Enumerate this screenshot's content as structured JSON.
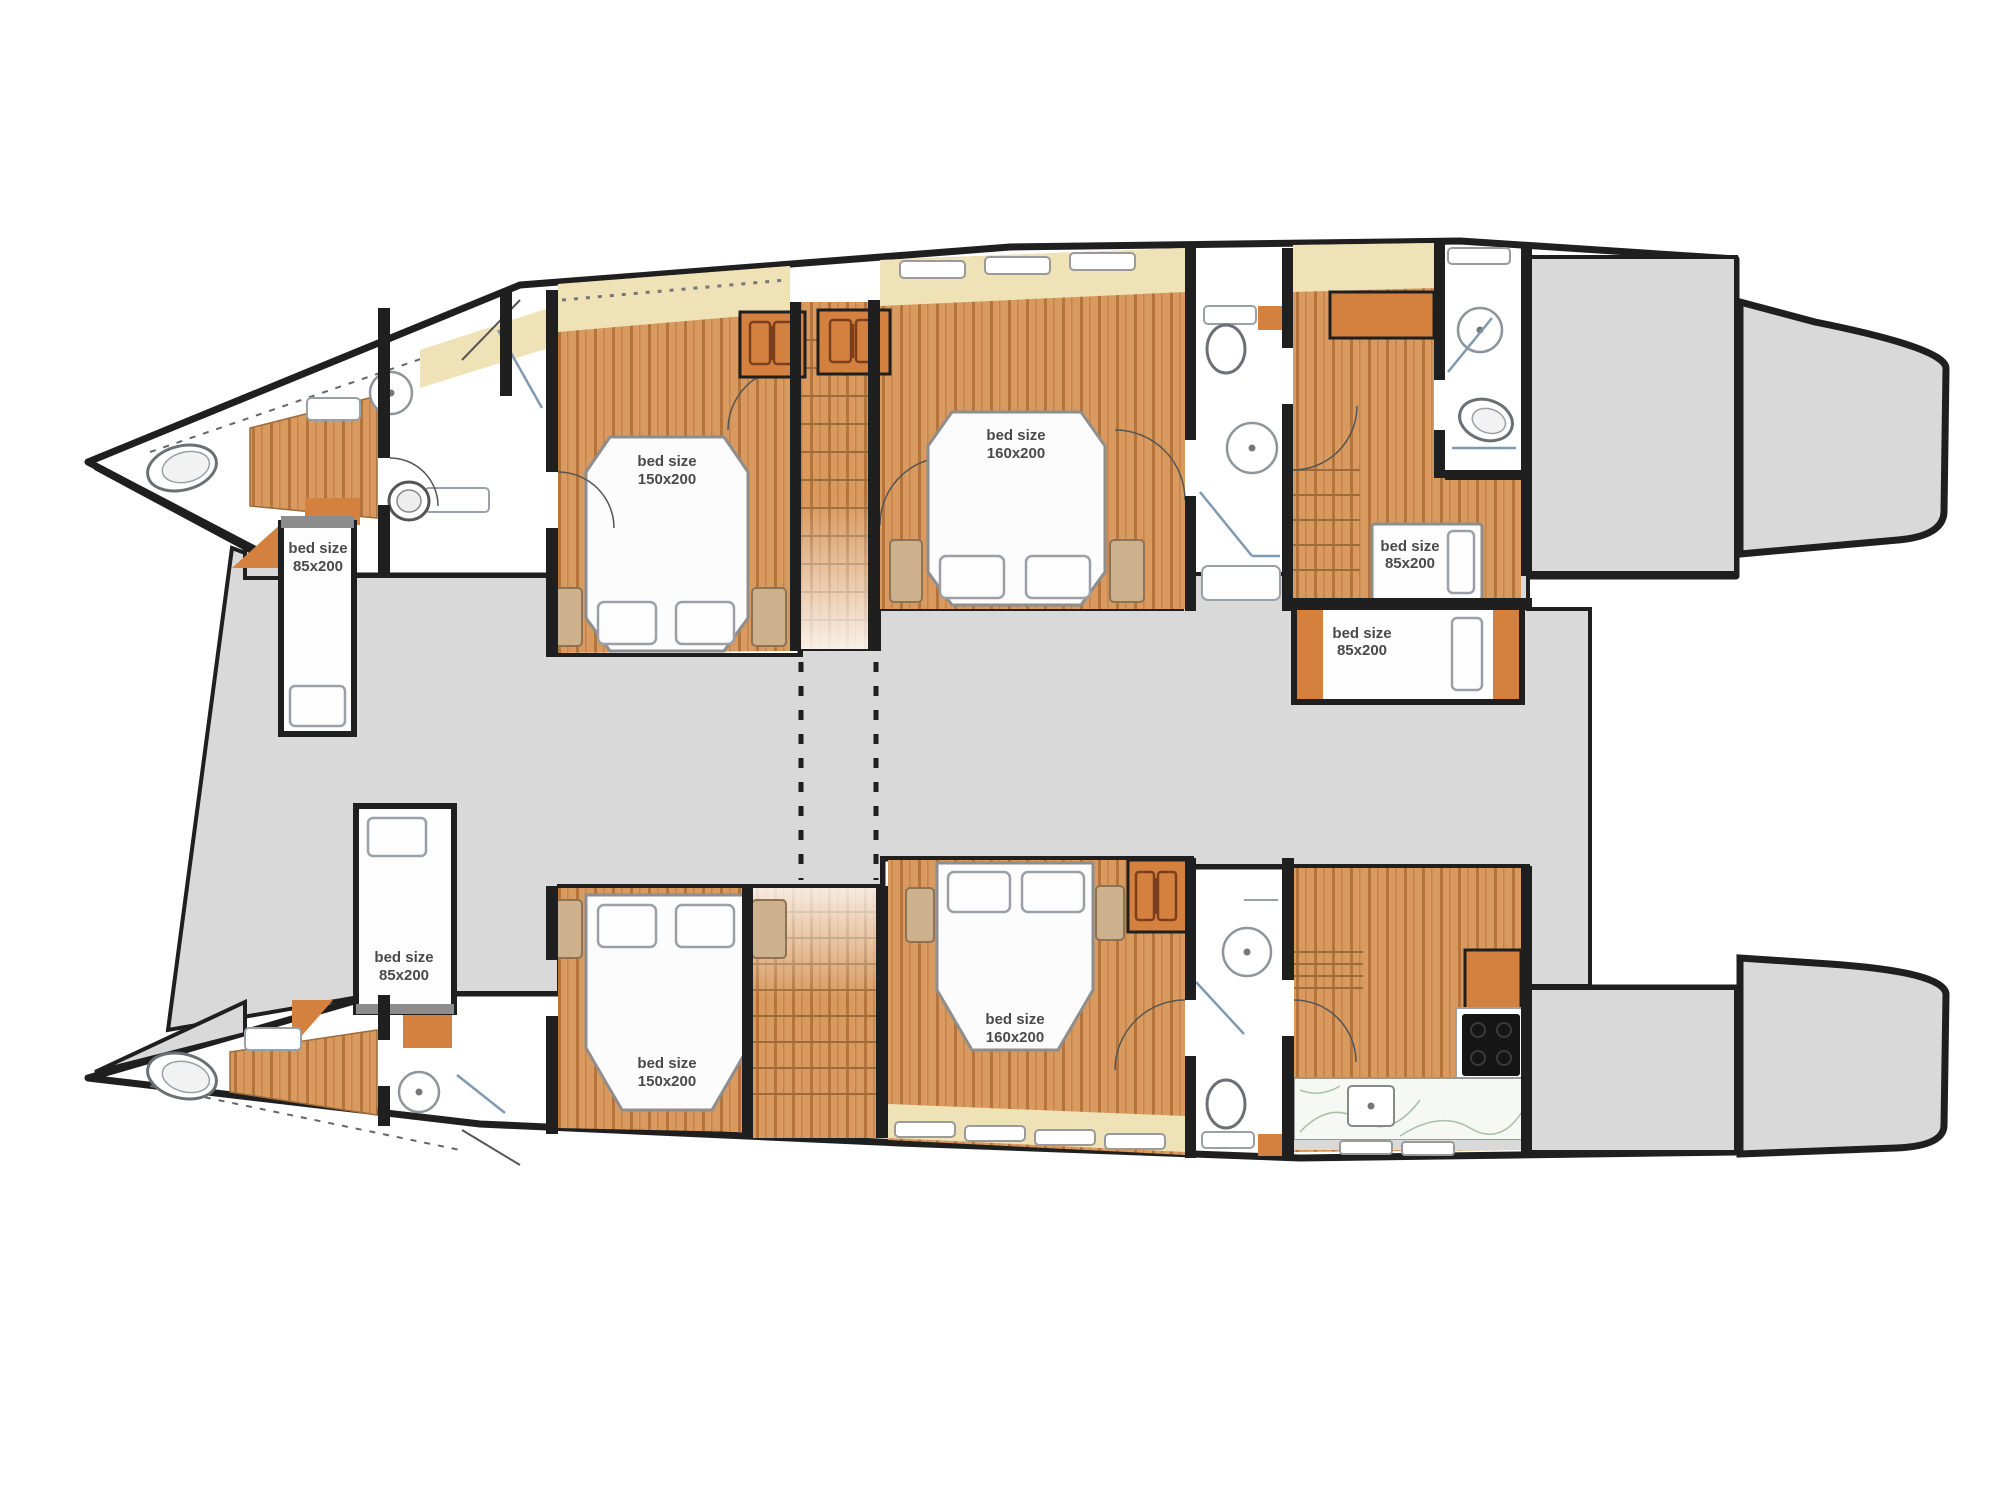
{
  "beds": [
    {
      "id": "port-bow-single",
      "size_label": "bed size",
      "size_value": "85x200"
    },
    {
      "id": "port-forward-double",
      "size_label": "bed size",
      "size_value": "150x200"
    },
    {
      "id": "port-aft-double",
      "size_label": "bed size",
      "size_value": "160x200"
    },
    {
      "id": "port-stern-upper-single",
      "size_label": "bed size",
      "size_value": "85x200"
    },
    {
      "id": "port-stern-lower-single",
      "size_label": "bed size",
      "size_value": "85x200"
    },
    {
      "id": "starboard-bow-single",
      "size_label": "bed size",
      "size_value": "85x200"
    },
    {
      "id": "starboard-forward-double",
      "size_label": "bed size",
      "size_value": "150x200"
    },
    {
      "id": "starboard-aft-double",
      "size_label": "bed size",
      "size_value": "160x200"
    }
  ],
  "colors": {
    "wall": "#1f1f1f",
    "wood_floor": "#d99a5f",
    "wood_plank_line": "#b5743c",
    "cabinet_orange": "#d4803f",
    "window_sill_cream": "#efe2b6",
    "deck_gray": "#d9d9d9",
    "fixture_outline": "#8e959b",
    "appliance_black": "#151515",
    "marble_counter": "#f6f8f4"
  }
}
